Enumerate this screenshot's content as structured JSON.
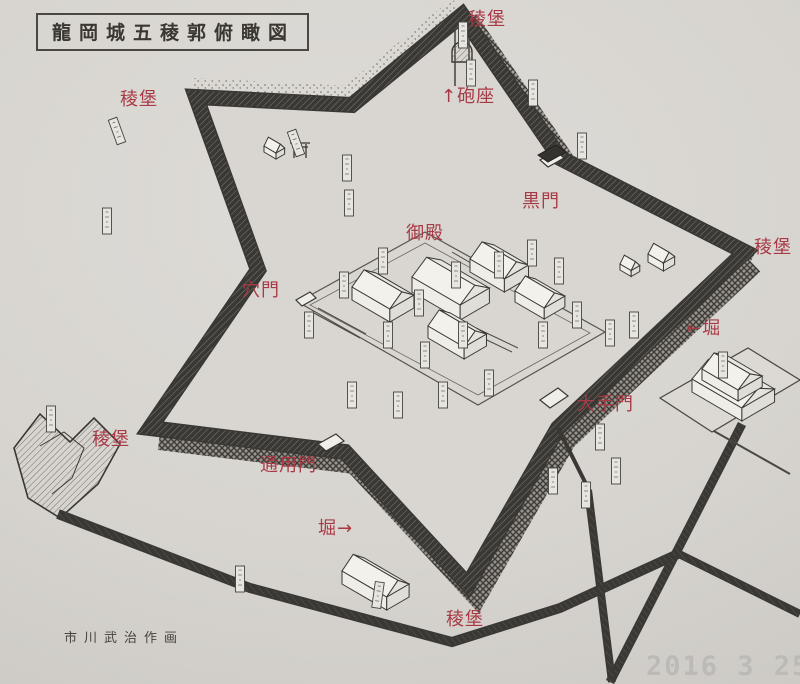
{
  "page": {
    "title": "龍岡城五稜郭俯瞰図",
    "signature": "市川武治作画",
    "datestamp": "2016  3 25"
  },
  "colors": {
    "paper": "#d7d4cf",
    "ink": "#3a3834",
    "annotation_red": "#a83a46",
    "datestamp_gray": "#b7b6b2"
  },
  "annotations": [
    {
      "text": "稜堡",
      "x": 468,
      "y": 5
    },
    {
      "text": "↑砲座",
      "x": 441,
      "y": 82
    },
    {
      "text": "稜堡",
      "x": 120,
      "y": 85
    },
    {
      "text": "黒門",
      "x": 522,
      "y": 187
    },
    {
      "text": "御殿",
      "x": 406,
      "y": 219
    },
    {
      "text": "稜堡",
      "x": 754,
      "y": 233
    },
    {
      "text": "←堀",
      "x": 686,
      "y": 314
    },
    {
      "text": "穴門",
      "x": 242,
      "y": 276
    },
    {
      "text": "大手門",
      "x": 577,
      "y": 390
    },
    {
      "text": "稜堡",
      "x": 92,
      "y": 425
    },
    {
      "text": "通用門",
      "x": 260,
      "y": 451
    },
    {
      "text": "堀→",
      "x": 318,
      "y": 514
    },
    {
      "text": "稜堡",
      "x": 446,
      "y": 605
    }
  ]
}
